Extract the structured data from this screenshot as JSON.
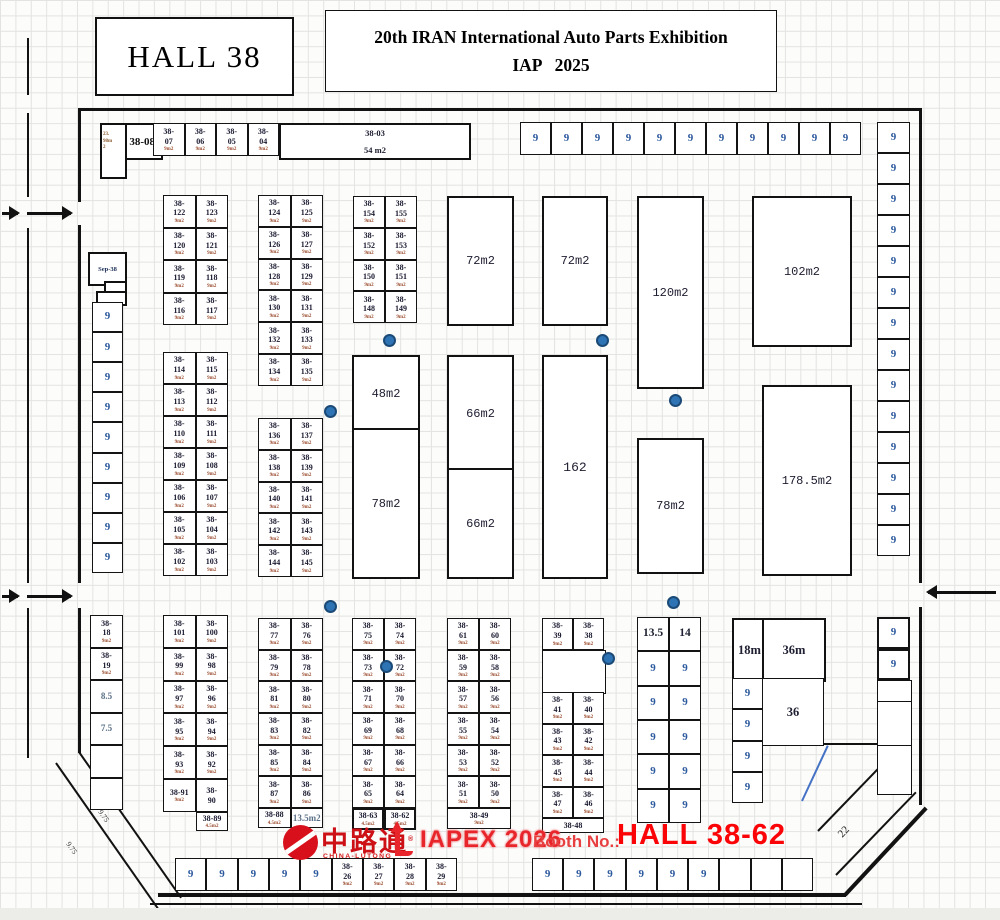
{
  "header": {
    "hall_title": "HALL 38",
    "exhibition_line1": "20th IRAN International Auto Parts Exhibition",
    "exhibition_line2": "IAP   2025"
  },
  "branding": {
    "logo_cn": "中路通",
    "logo_reg": "®",
    "logo_en": "CHINA-LUTONG",
    "event": "IAPEX 2026",
    "booth_label": "Booth No.:",
    "booth_value": "HALL 38-62"
  },
  "colors": {
    "accent_red": "#e8252a",
    "booth_number_blue": "#2d5a9e",
    "marker_dot_blue": "#2e74b5"
  },
  "areas": {
    "a03": {
      "label": "38-03\n54 m2"
    },
    "a08": {
      "label": "38-08"
    },
    "a08tab": {
      "label": "23.\n98m\n2"
    },
    "sep38": {
      "label": "Sep-38"
    },
    "a72a": {
      "label": "72m2"
    },
    "a72b": {
      "label": "72m2"
    },
    "a120": {
      "label": "120m2"
    },
    "a102": {
      "label": "102m2"
    },
    "a48": {
      "label": "48m2"
    },
    "a78a": {
      "label": "78m2"
    },
    "a66a": {
      "label": "66m2"
    },
    "a66b": {
      "label": "66m2"
    },
    "a162": {
      "label": "162"
    },
    "a78b": {
      "label": "78m2"
    },
    "a178": {
      "label": "178.5m2"
    },
    "a18m": {
      "label": "18m"
    },
    "a36m": {
      "label": "36m"
    },
    "a36": {
      "label": "36"
    },
    "l975": {
      "label": "9.75"
    },
    "l22": {
      "label": "22"
    }
  },
  "groups": {
    "topBooths": {
      "sub": "9m2",
      "rows": [
        [
          "38-\n07",
          "38-\n06",
          "38-\n05",
          "38-\n04"
        ]
      ]
    },
    "topNine": {
      "rows": [
        [
          "9",
          "9",
          "9",
          "9",
          "9",
          "9",
          "9",
          "9",
          "9",
          "9",
          "9"
        ]
      ]
    },
    "rightCol": {
      "rows": [
        [
          "9"
        ],
        [
          "9"
        ],
        [
          "9"
        ],
        [
          "9"
        ],
        [
          "9"
        ],
        [
          "9"
        ],
        [
          "9"
        ],
        [
          "9"
        ],
        [
          "9"
        ],
        [
          "9"
        ],
        [
          "9"
        ],
        [
          "9"
        ],
        [
          "9"
        ],
        [
          "9"
        ]
      ]
    },
    "leftCol": {
      "rows": [
        [
          "9"
        ],
        [
          "9"
        ],
        [
          "9"
        ],
        [
          "9"
        ],
        [
          "9"
        ],
        [
          "9"
        ],
        [
          "9"
        ],
        [
          "9"
        ],
        [
          "9"
        ]
      ]
    },
    "gA1": {
      "sub": "9m2",
      "rows": [
        [
          "38-\n122",
          "38-\n123"
        ],
        [
          "38-\n120",
          "38-\n121"
        ],
        [
          "38-\n119",
          "38-\n118"
        ],
        [
          "38-\n116",
          "38-\n117"
        ]
      ]
    },
    "gA2": {
      "sub": "9m2",
      "rows": [
        [
          "38-\n114",
          "38-\n115"
        ],
        [
          "38-\n113",
          "38-\n112"
        ],
        [
          "38-\n110",
          "38-\n111"
        ],
        [
          "38-\n109",
          "38-\n108"
        ],
        [
          "38-\n106",
          "38-\n107"
        ],
        [
          "38-\n105",
          "38-\n104"
        ],
        [
          "38-\n102",
          "38-\n103"
        ]
      ]
    },
    "gB1": {
      "sub": "9m2",
      "rows": [
        [
          "38-\n124",
          "38-\n125"
        ],
        [
          "38-\n126",
          "38-\n127"
        ],
        [
          "38-\n128",
          "38-\n129"
        ],
        [
          "38-\n130",
          "38-\n131"
        ],
        [
          "38-\n132",
          "38-\n133"
        ],
        [
          "38-\n134",
          "38-\n135"
        ]
      ]
    },
    "gB2": {
      "sub": "9m2",
      "rows": [
        [
          "38-\n136",
          "38-\n137"
        ],
        [
          "38-\n138",
          "38-\n139"
        ],
        [
          "38-\n140",
          "38-\n141"
        ],
        [
          "38-\n142",
          "38-\n143"
        ],
        [
          "38-\n144",
          "38-\n145"
        ]
      ]
    },
    "gC": {
      "sub": "9m2",
      "rows": [
        [
          "38-\n154",
          "38-\n155"
        ],
        [
          "38-\n152",
          "38-\n153"
        ],
        [
          "38-\n150",
          "38-\n151"
        ],
        [
          "38-\n148",
          "38-\n149"
        ]
      ]
    },
    "gD": {
      "sub": "9m2",
      "rows": [
        [
          "38-\n101",
          "38-\n100"
        ],
        [
          "38-\n99",
          "38-\n98"
        ],
        [
          "38-\n97",
          "38-\n96"
        ],
        [
          "38-\n95",
          "38-\n94"
        ],
        [
          "38-\n93",
          "38-\n92"
        ],
        [
          {
            "t": "38-91",
            "s": "9m2"
          },
          {
            "t": "38-\n90"
          }
        ]
      ]
    },
    "g89": {
      "rows": [
        [
          {
            "t": "38-89",
            "s": "4.5m2"
          }
        ]
      ]
    },
    "gE": {
      "sub": "9m2",
      "rows": [
        [
          "38-\n77",
          "38-\n76"
        ],
        [
          "38-\n79",
          "38-\n78"
        ],
        [
          "38-\n81",
          "38-\n80"
        ],
        [
          "38-\n83",
          "38-\n82"
        ],
        [
          "38-\n85",
          "38-\n84"
        ],
        [
          "38-\n87",
          "38-\n86"
        ]
      ]
    },
    "gEb": {
      "rows": [
        [
          {
            "t": "38-88",
            "s": "4.5m2"
          },
          {
            "t": "13.5m2",
            "cls": "lite"
          }
        ]
      ]
    },
    "gF": {
      "sub": "9m2",
      "rows": [
        [
          "38-\n75",
          "38-\n74"
        ],
        [
          "38-\n73",
          "38-\n72"
        ],
        [
          "38-\n71",
          "38-\n70"
        ],
        [
          "38-\n69",
          "38-\n68"
        ],
        [
          "38-\n67",
          "38-\n66"
        ],
        [
          "38-\n65",
          "38-\n64"
        ]
      ]
    },
    "gFb": {
      "rows": [
        [
          {
            "t": "38-63",
            "s": "4.5m2",
            "b": 1
          },
          {
            "t": "38-62",
            "s": "4.5m2",
            "b": 1
          }
        ]
      ]
    },
    "gG": {
      "sub": "9m2",
      "rows": [
        [
          "38-\n61",
          "38-\n60"
        ],
        [
          "38-\n59",
          "38-\n58"
        ],
        [
          "38-\n57",
          "38-\n56"
        ],
        [
          "38-\n55",
          "38-\n54"
        ],
        [
          "38-\n53",
          "38-\n52"
        ],
        [
          "38-\n51",
          "38-\n50"
        ]
      ]
    },
    "gGb": {
      "rows": [
        [
          {
            "t": "38-49",
            "s": "9m2"
          }
        ]
      ]
    },
    "gH1": {
      "sub": "9m2",
      "rows": [
        [
          "38-\n39",
          "38-\n38"
        ]
      ]
    },
    "gH2": {
      "sub": "9m2",
      "rows": [
        [
          "38-\n41",
          "38-\n40"
        ],
        [
          "38-\n43",
          "38-\n42"
        ],
        [
          "38-\n45",
          "38-\n44"
        ],
        [
          "38-\n47",
          "38-\n46"
        ]
      ]
    },
    "gH3": {
      "rows": [
        [
          {
            "t": "38-48"
          }
        ]
      ]
    },
    "gI": {
      "rows": [
        [
          {
            "t": "13.5",
            "cls": "big"
          },
          {
            "t": "14",
            "cls": "big"
          }
        ],
        [
          "9",
          "9"
        ],
        [
          "9",
          "9"
        ],
        [
          "9",
          "9"
        ],
        [
          "9",
          "9"
        ],
        [
          "9",
          "9"
        ]
      ]
    },
    "gJ9": {
      "rows": [
        [
          "9"
        ],
        [
          "9"
        ],
        [
          "9"
        ],
        [
          "9"
        ]
      ]
    },
    "rightBold9": {
      "rows": [
        [
          {
            "t": "9",
            "b": 1
          }
        ],
        [
          {
            "t": "9",
            "b": 1
          }
        ]
      ]
    },
    "bottomLeft": {
      "sub": "",
      "rows": [
        [
          "9",
          "9",
          "9",
          "9",
          "9",
          {
            "t": "38-\n26",
            "s": "9m2"
          },
          {
            "t": "38-\n27",
            "s": "9m2"
          },
          {
            "t": "38-\n28",
            "s": "9m2"
          },
          {
            "t": "38-\n29",
            "s": "9m2"
          }
        ]
      ]
    },
    "bottomRight": {
      "rows": [
        [
          "9",
          "9",
          "9",
          "9",
          "9",
          "9",
          {
            "t": ""
          },
          {
            "t": ""
          },
          {
            "t": ""
          }
        ]
      ]
    },
    "leftLower": {
      "rows": [
        [
          {
            "t": "38-\n18",
            "s": "9m2"
          }
        ],
        [
          {
            "t": "38-\n19",
            "s": "9m2"
          }
        ],
        [
          {
            "t": "8.5",
            "cls": "lite"
          }
        ],
        [
          {
            "t": "7.5",
            "cls": "lite"
          }
        ],
        [
          {
            "t": ""
          }
        ],
        [
          {
            "t": ""
          }
        ]
      ]
    },
    "rightNarrow": {
      "rows": [
        [
          {
            "t": ""
          }
        ],
        [
          {
            "t": ""
          }
        ],
        [
          {
            "t": ""
          }
        ]
      ]
    }
  }
}
